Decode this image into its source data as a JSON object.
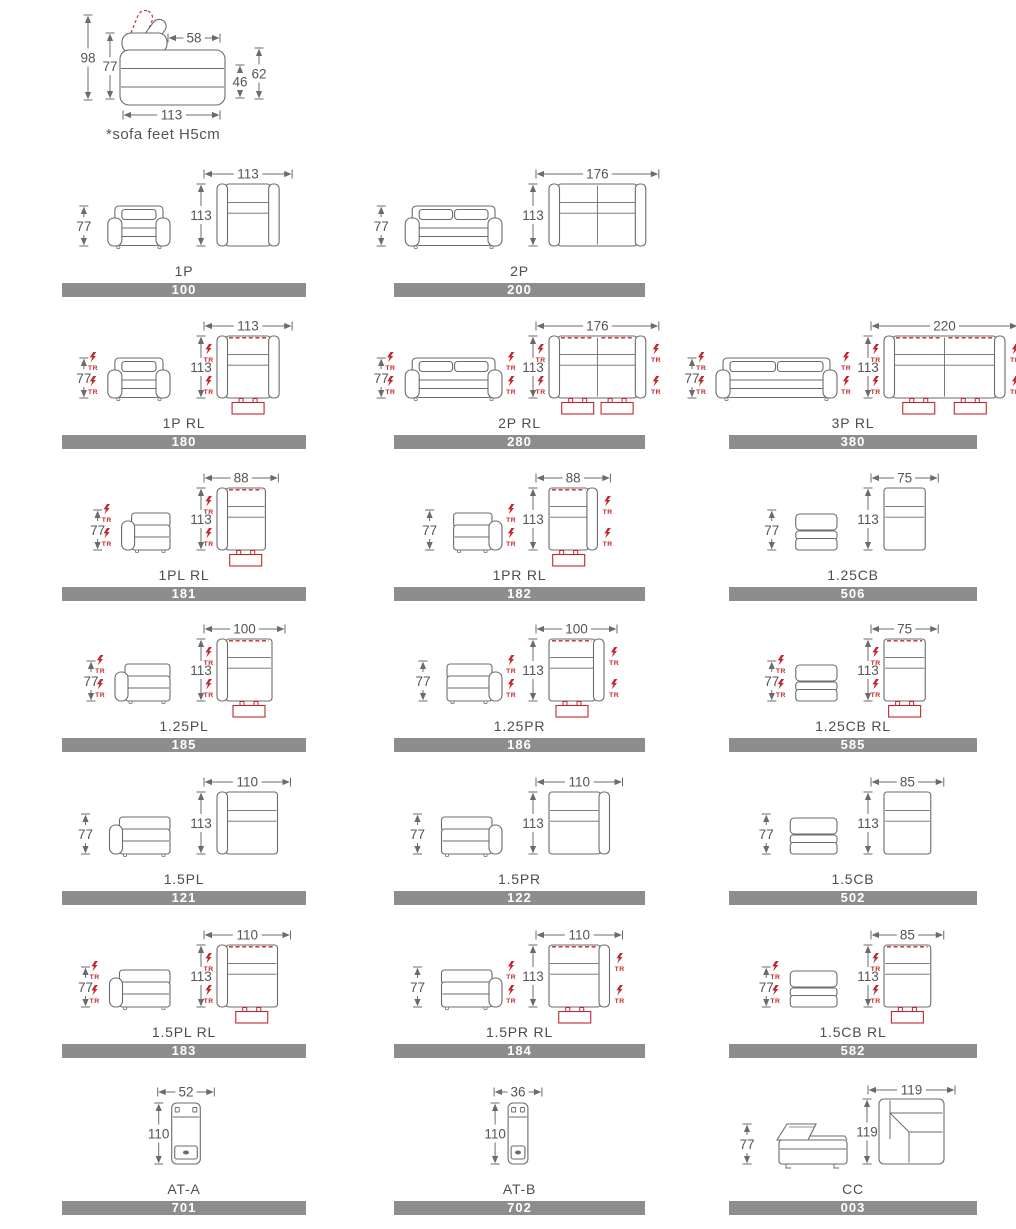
{
  "colors": {
    "line": "#6b6b6b",
    "dim_text": "#555555",
    "red": "#c1272d",
    "bar_bg": "#8d8d8d",
    "bar_text": "#ffffff",
    "label_text": "#4d4d4d"
  },
  "tr_label": "TR",
  "header": {
    "note": "*sofa feet H5cm",
    "dims": {
      "total_height": "98",
      "back_height": "77",
      "headrest_depth": "58",
      "backrest_top_height": "62",
      "seat_height": "46",
      "total_depth": "113"
    }
  },
  "rows": [
    [
      {
        "label": "1P",
        "code": "100",
        "width": "113",
        "depth": "113",
        "height": "77",
        "type": "sofa",
        "arms": "both",
        "sections": 1,
        "recliner": false,
        "tr_sides": []
      },
      {
        "label": "2P",
        "code": "200",
        "width": "176",
        "depth": "113",
        "height": "77",
        "type": "sofa",
        "arms": "both",
        "sections": 2,
        "recliner": false,
        "tr_sides": []
      }
    ],
    [
      {
        "label": "1P RL",
        "code": "180",
        "width": "113",
        "depth": "113",
        "height": "77",
        "type": "sofa",
        "arms": "both",
        "sections": 1,
        "recliner": true,
        "tr_sides": [
          "left"
        ]
      },
      {
        "label": "2P RL",
        "code": "280",
        "width": "176",
        "depth": "113",
        "height": "77",
        "type": "sofa",
        "arms": "both",
        "sections": 2,
        "recliner": true,
        "tr_sides": [
          "left",
          "right"
        ]
      },
      {
        "label": "3P RL",
        "code": "380",
        "width": "220",
        "depth": "113",
        "height": "77",
        "type": "sofa",
        "arms": "both",
        "sections": 2,
        "recliner": true,
        "tr_sides": [
          "left",
          "right"
        ]
      }
    ],
    [
      {
        "label": "1PL RL",
        "code": "181",
        "width": "88",
        "depth": "113",
        "height": "77",
        "type": "sofa",
        "arms": "left",
        "sections": 1,
        "recliner": true,
        "tr_sides": [
          "left"
        ]
      },
      {
        "label": "1PR RL",
        "code": "182",
        "width": "88",
        "depth": "113",
        "height": "77",
        "type": "sofa",
        "arms": "right",
        "sections": 1,
        "recliner": true,
        "tr_sides": [
          "right"
        ]
      },
      {
        "label": "1.25CB",
        "code": "506",
        "width": "75",
        "depth": "113",
        "height": "77",
        "type": "sofa",
        "arms": "none",
        "sections": 1,
        "recliner": false,
        "tr_sides": []
      }
    ],
    [
      {
        "label": "1.25PL",
        "code": "185",
        "width": "100",
        "depth": "113",
        "height": "77",
        "type": "sofa",
        "arms": "left",
        "sections": 1,
        "recliner": true,
        "tr_sides": [
          "left"
        ]
      },
      {
        "label": "1.25PR",
        "code": "186",
        "width": "100",
        "depth": "113",
        "height": "77",
        "type": "sofa",
        "arms": "right",
        "sections": 1,
        "recliner": true,
        "tr_sides": [
          "right"
        ]
      },
      {
        "label": "1.25CB RL",
        "code": "585",
        "width": "75",
        "depth": "113",
        "height": "77",
        "type": "sofa",
        "arms": "none",
        "sections": 1,
        "recliner": true,
        "tr_sides": [
          "left"
        ]
      }
    ],
    [
      {
        "label": "1.5PL",
        "code": "121",
        "width": "110",
        "depth": "113",
        "height": "77",
        "type": "sofa",
        "arms": "left",
        "sections": 1,
        "recliner": false,
        "tr_sides": []
      },
      {
        "label": "1.5PR",
        "code": "122",
        "width": "110",
        "depth": "113",
        "height": "77",
        "type": "sofa",
        "arms": "right",
        "sections": 1,
        "recliner": false,
        "tr_sides": []
      },
      {
        "label": "1.5CB",
        "code": "502",
        "width": "85",
        "depth": "113",
        "height": "77",
        "type": "sofa",
        "arms": "none",
        "sections": 1,
        "recliner": false,
        "tr_sides": []
      }
    ],
    [
      {
        "label": "1.5PL RL",
        "code": "183",
        "width": "110",
        "depth": "113",
        "height": "77",
        "type": "sofa",
        "arms": "left",
        "sections": 1,
        "recliner": true,
        "tr_sides": [
          "left"
        ]
      },
      {
        "label": "1.5PR RL",
        "code": "184",
        "width": "110",
        "depth": "113",
        "height": "77",
        "type": "sofa",
        "arms": "right",
        "sections": 1,
        "recliner": true,
        "tr_sides": [
          "right"
        ]
      },
      {
        "label": "1.5CB RL",
        "code": "582",
        "width": "85",
        "depth": "113",
        "height": "77",
        "type": "sofa",
        "arms": "none",
        "sections": 1,
        "recliner": true,
        "tr_sides": [
          "left"
        ]
      }
    ],
    [
      {
        "label": "AT-A",
        "code": "701",
        "width": "52",
        "depth": "110",
        "type": "console"
      },
      {
        "label": "AT-B",
        "code": "702",
        "width": "36",
        "depth": "110",
        "type": "console"
      },
      {
        "label": "CC",
        "code": "003",
        "width": "119",
        "depth": "119",
        "height": "77",
        "type": "corner"
      }
    ]
  ]
}
